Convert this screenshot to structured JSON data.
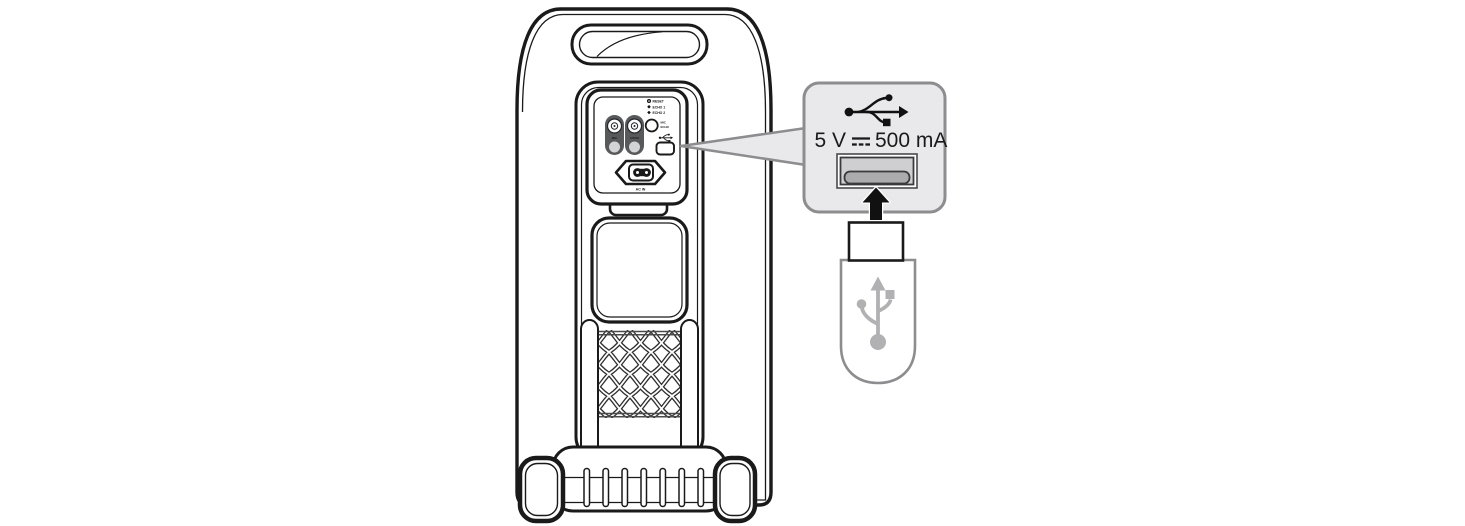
{
  "figure": {
    "type": "manual-illustration",
    "subject": "Party speaker rear panel with USB power callout and USB flash drive being inserted",
    "colors": {
      "outline": "#1a1a1a",
      "callout_fill": "#e9e9eb",
      "callout_border": "#8d8d90",
      "panel_dark": "#58595b",
      "port_inner": "#cfcfd1",
      "port_tongue": "#ababad",
      "drive_icon_gray": "#b1b1b3"
    },
    "rear_panel": {
      "indicators": [
        {
          "label": "RESET"
        },
        {
          "label": "ECHO 1"
        },
        {
          "label": "ECHO 2"
        }
      ],
      "knob_label": [
        "MIC",
        "ECHO"
      ],
      "jacks": [
        {
          "label": "MIC"
        },
        {
          "label": "GUITAR"
        }
      ],
      "power_inlet_label": "AC IN"
    },
    "callout": {
      "rating": {
        "voltage": "5 V",
        "dc_symbol": "⎓",
        "current": "500 mA",
        "full": "5 V ⎓ 500 mA"
      }
    }
  }
}
